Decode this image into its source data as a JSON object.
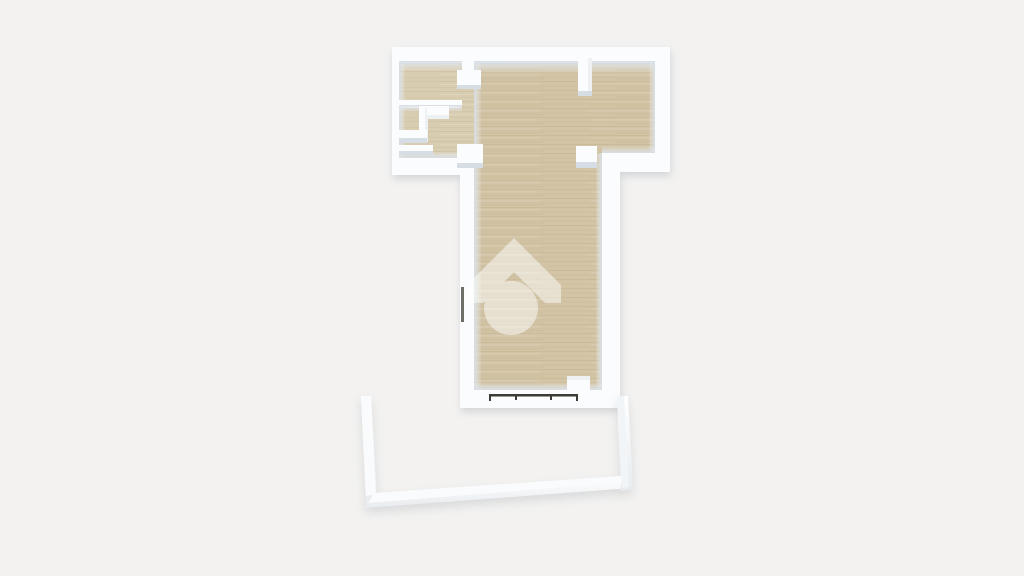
{
  "scene": {
    "type": "3d-floorplan-top-down-render",
    "background_color": "#f3f2f1"
  },
  "colors": {
    "wall_top": "#fbfcfd",
    "wall_face_light": "#edf1f4",
    "wall_face_mid": "#d6dde4",
    "wall_face_dark": "#c9d0d8",
    "floor_main": "#d2c4a5",
    "floor_light": "#d8ccb1",
    "floor_grain": "#b3a280",
    "window_frame": "#3a3b38",
    "door_frame": "#6e6e66",
    "watermark_white": "#ffffff",
    "shadow": "#9aa0a6"
  },
  "watermark": {
    "icon": "house-in-circle",
    "opacity": 0.5
  }
}
